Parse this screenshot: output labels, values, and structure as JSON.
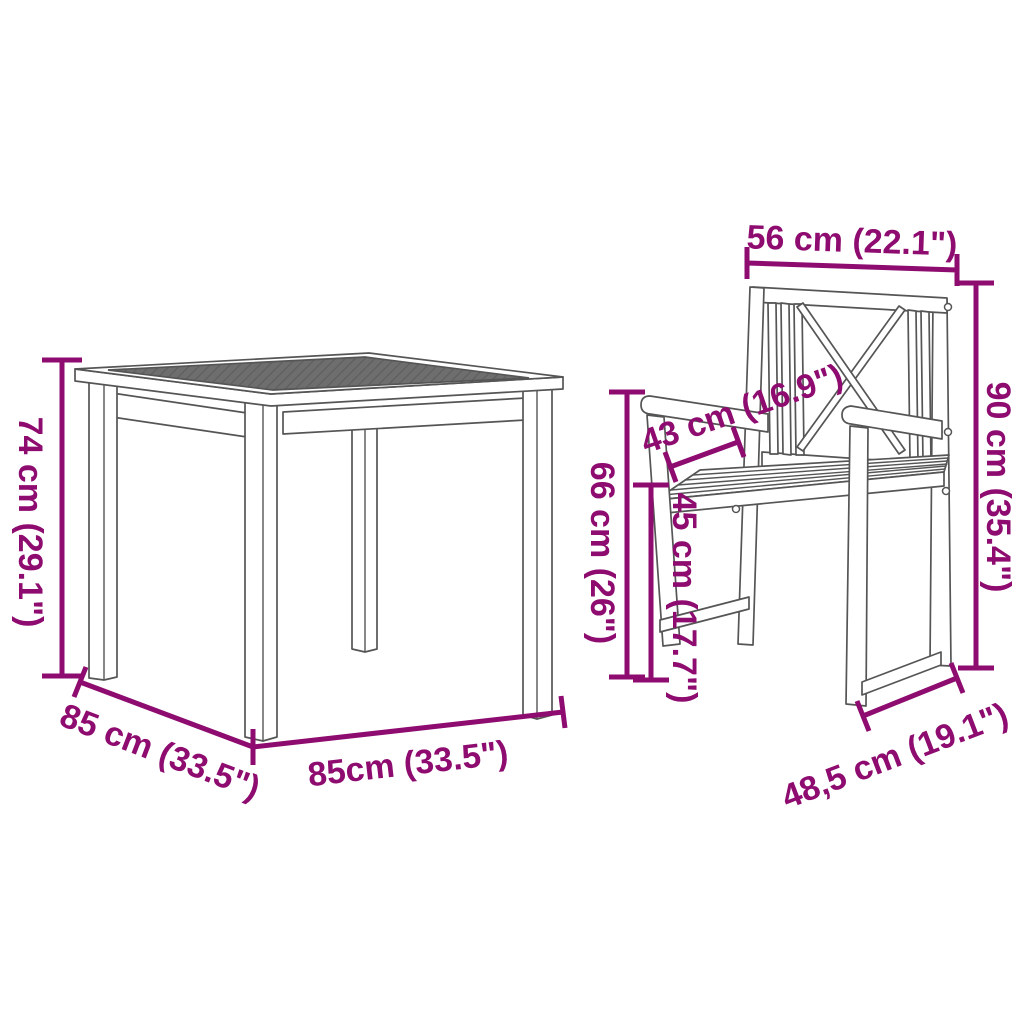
{
  "diagram": {
    "type": "product-dimension-diagram",
    "figures": {
      "table": "square garden dining table",
      "chair": "garden armchair with crossed backrest"
    },
    "colors": {
      "background": "#ffffff",
      "dimension": "#8e0b6f",
      "line_art": "#555555",
      "tabletop_texture": "#6e6e6e"
    },
    "measurements": {
      "table": [
        {
          "id": "table-height",
          "label": "74 cm (29.1\")"
        },
        {
          "id": "table-depth",
          "label": "85 cm (33.5\")"
        },
        {
          "id": "table-width",
          "label": "85cm (33.5\")"
        }
      ],
      "chair": [
        {
          "id": "chair-back-width",
          "label": "56 cm (22.1\")"
        },
        {
          "id": "chair-height",
          "label": "90 cm (35.4\")"
        },
        {
          "id": "chair-armrest-length",
          "label": "43 cm (16.9\")"
        },
        {
          "id": "chair-armrest-height",
          "label": "66 cm (26\")"
        },
        {
          "id": "chair-seat-height",
          "label": "45 cm (17.7\")"
        },
        {
          "id": "chair-seat-width",
          "label": "48,5 cm (19.1\")"
        }
      ]
    }
  }
}
